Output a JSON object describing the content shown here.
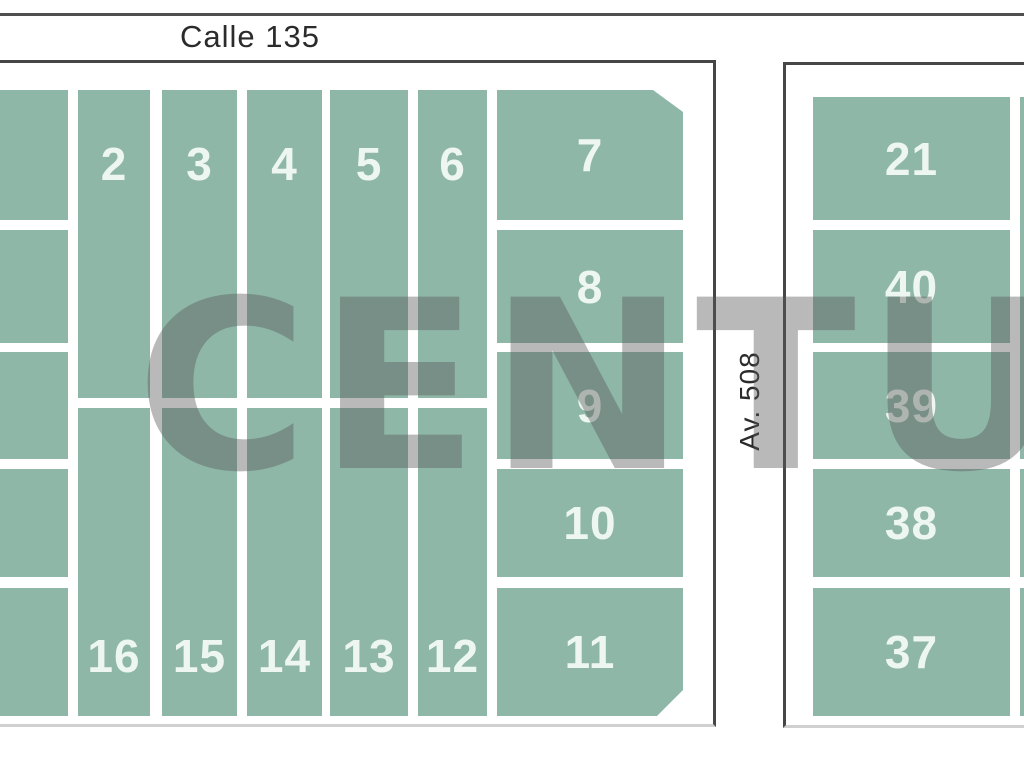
{
  "streets": {
    "top_street": "Calle 135",
    "cross_street": "Av. 508"
  },
  "watermark_text": "CENTURY",
  "left_block": {
    "top_row_lots": [
      "2",
      "3",
      "4",
      "5",
      "6"
    ],
    "bottom_row_lots": [
      "16",
      "15",
      "14",
      "13",
      "12"
    ],
    "east_column_lots": [
      "7",
      "8",
      "9",
      "10",
      "11"
    ],
    "west_edge_unlabeled_lot_count": 5
  },
  "right_block": {
    "west_column_lots": [
      "21",
      "40",
      "39",
      "38",
      "37"
    ]
  },
  "colors": {
    "background": "#ffffff",
    "lot_fill": "#8EB7A8",
    "lot_label": "#EDF6F0",
    "block_border": "#464646",
    "street_line": "#4f4f4f",
    "street_text": "#2b2b2b",
    "watermark": "rgba(88,88,88,0.42)"
  }
}
